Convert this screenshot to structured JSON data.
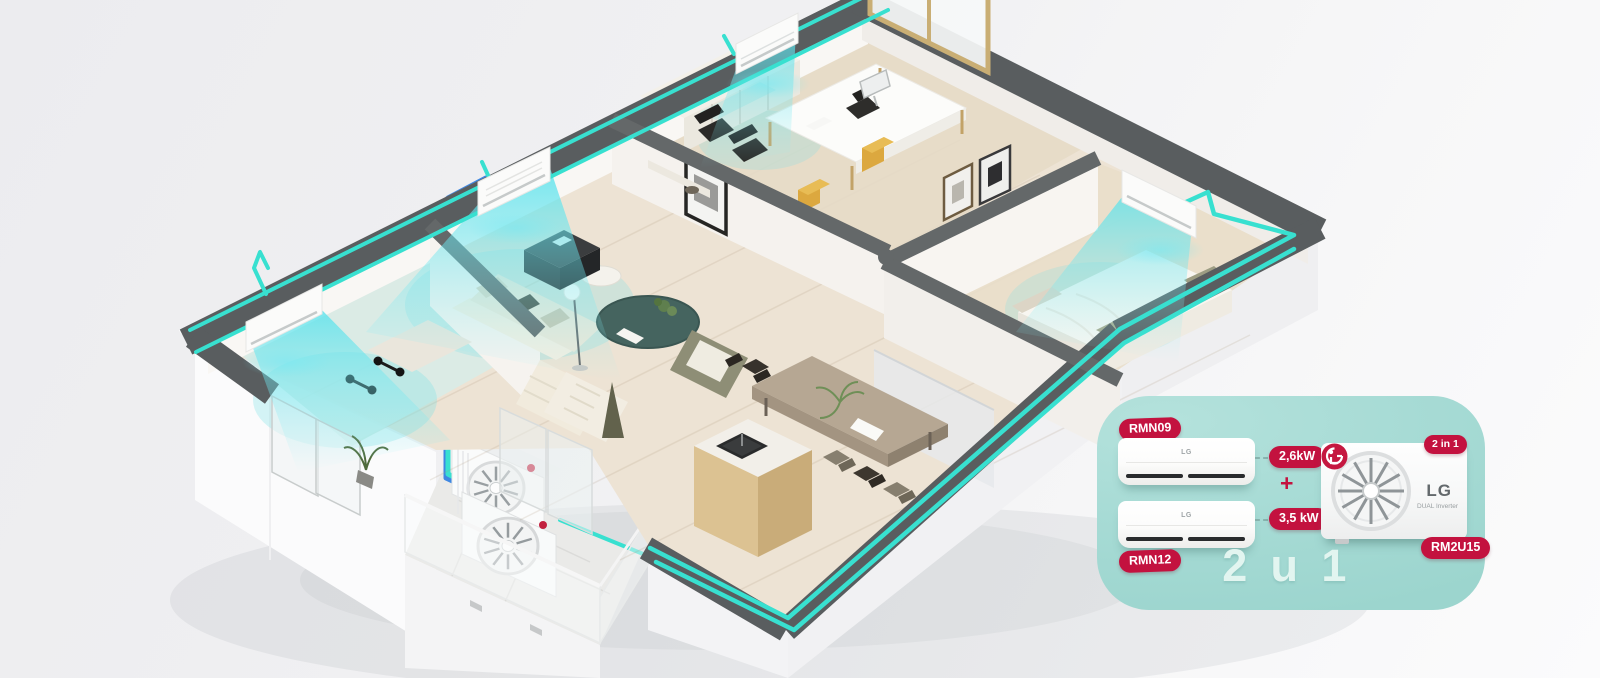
{
  "card": {
    "brand": "LG",
    "tagline": "DUAL Inverter",
    "plus": "+",
    "combo_badge": "2 in 1",
    "big_text": "2 u 1",
    "outdoor_model": "RM2U15",
    "indoor_units": [
      {
        "model": "RMN09",
        "capacity": "2,6kW"
      },
      {
        "model": "RMN12",
        "capacity": "3,5 kW"
      }
    ],
    "colors": {
      "card_background": "#A7DBD5",
      "badge_red": "#C3123F",
      "big_text_color": "#E2F5F0"
    }
  },
  "scene": {
    "colors": {
      "pipe_teal": "#38E0D0",
      "pipe_blue": "#3E87E2",
      "wall_top_gray": "#595D5F",
      "air_stream_cyan": "#5EE4EE",
      "floor_wood": "#EDE3D4"
    },
    "icons": [
      "indoor-ac-unit-icon",
      "outdoor-ac-unit-icon",
      "fan-icon",
      "lg-logo-icon",
      "airflow-icon",
      "refrigerant-pipe-icon"
    ]
  }
}
